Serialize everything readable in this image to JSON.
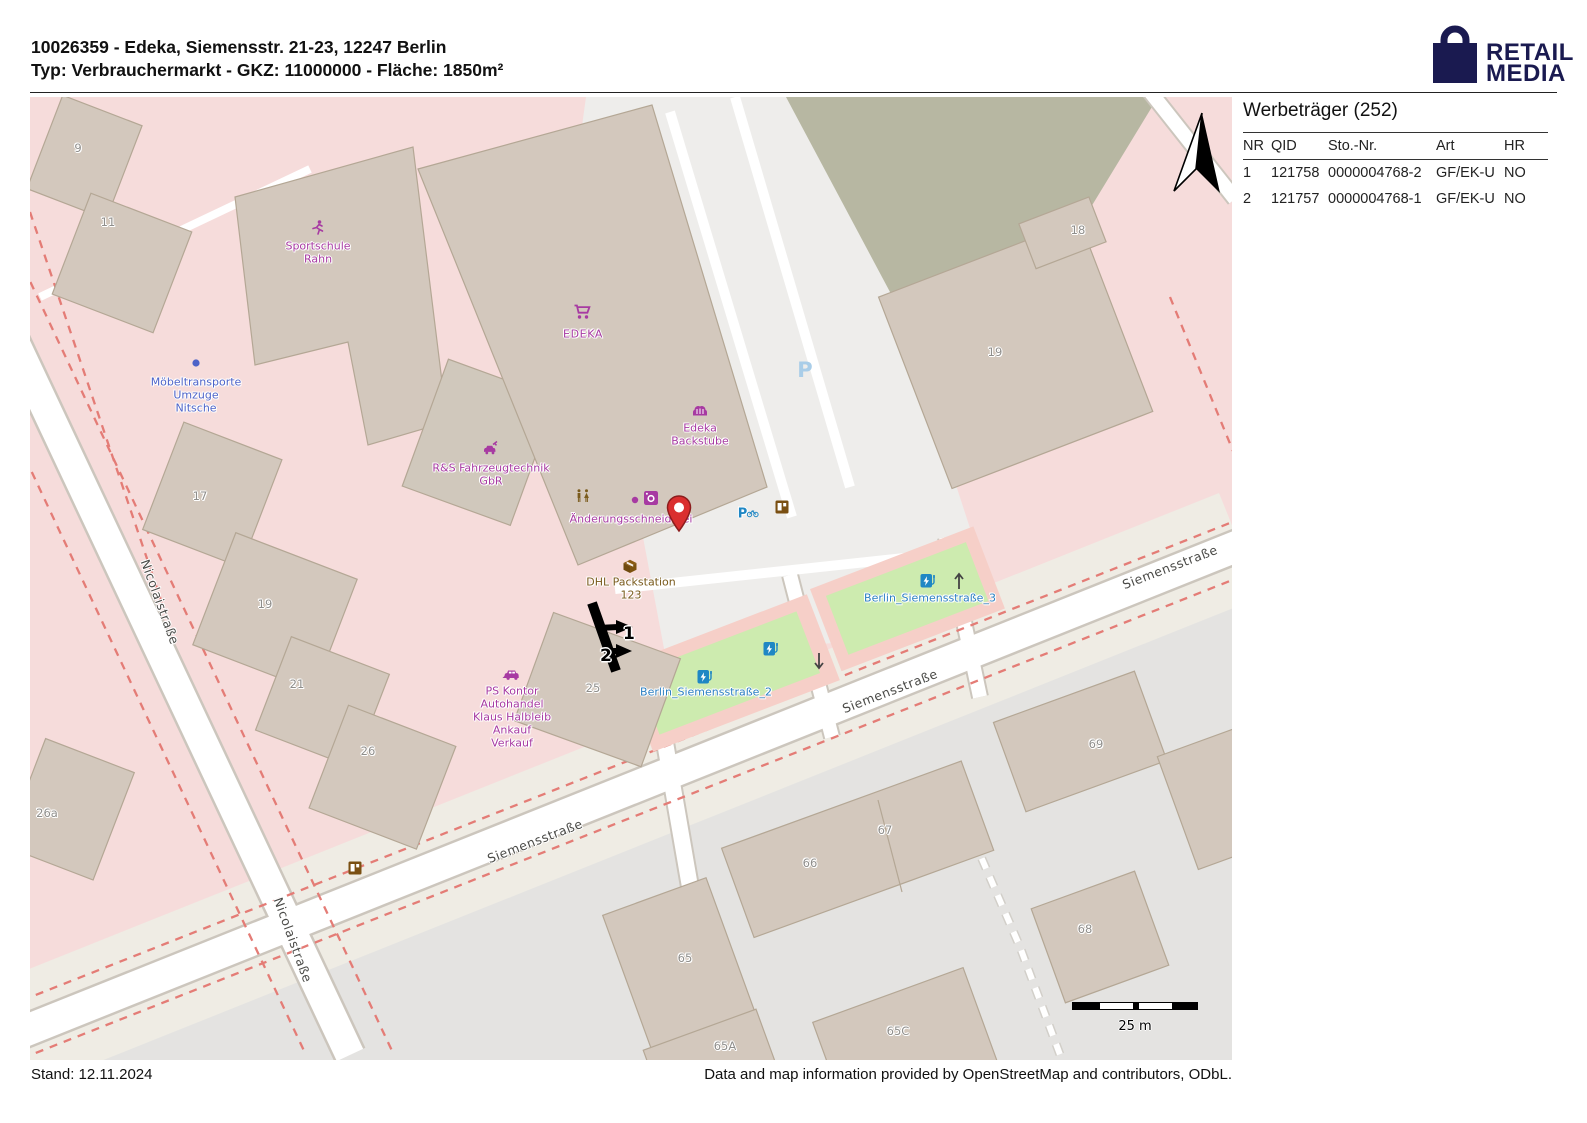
{
  "header": {
    "title_line1": "10026359 - Edeka, Siemensstr. 21-23, 12247 Berlin",
    "title_line2": "Typ: Verbrauchermarkt - GKZ: 11000000 - Fläche: 1850m²",
    "logo_line1": "RETAIL",
    "logo_line2": "MEDIA"
  },
  "panel": {
    "title": "Werbeträger (252)",
    "columns": [
      "NR",
      "QID",
      "Sto.-Nr.",
      "Art",
      "HR"
    ],
    "rows": [
      {
        "nr": "1",
        "qid": "121758",
        "sto_nr": "0000004768-2",
        "art": "GF/EK-U",
        "hr": "NO"
      },
      {
        "nr": "2",
        "qid": "121757",
        "sto_nr": "0000004768-1",
        "art": "GF/EK-U",
        "hr": "NO"
      }
    ]
  },
  "map": {
    "streets": {
      "nicolaistrasse": "Nicolaistraße",
      "siemensstrasse": "Siemensstraße"
    },
    "pois": {
      "sportschule_1": "Sportschule",
      "sportschule_2": "Rahn",
      "moebel_1": "Möbeltransporte",
      "moebel_2": "Umzuge",
      "moebel_3": "Nitsche",
      "edeka": "EDEKA",
      "backstube_1": "Edeka",
      "backstube_2": "Backstube",
      "fahrzeugtechnik_1": "R&S Fahrzeugtechnik",
      "fahrzeugtechnik_2": "GbR",
      "schneiderei": "Änderungsschneiderei",
      "dhl_1": "DHL Packstation",
      "dhl_2": "123",
      "pskontor_1": "PS Kontor",
      "pskontor_2": "Autohandel",
      "pskontor_3": "Klaus Halbleib",
      "pskontor_4": "Ankauf",
      "pskontor_5": "Verkauf",
      "charging_2": "Berlin_Siemensstraße_2",
      "charging_3": "Berlin_Siemensstraße_3",
      "parking_large": "P",
      "parking_small": "P"
    },
    "house_numbers": {
      "h9": "9",
      "h11": "11",
      "h17": "17",
      "h18": "18",
      "h19_left": "19",
      "h19_right": "19",
      "h21": "21",
      "h25": "25",
      "h26": "26",
      "h26a": "26a",
      "h65": "65",
      "h65a": "65A",
      "h65c": "65C",
      "h66": "66",
      "h67": "67",
      "h68": "68",
      "h69": "69"
    },
    "markers": {
      "marker_1": "1",
      "marker_2": "2"
    },
    "scale_label": "25 m"
  },
  "footer": {
    "stand": "Stand: 12.11.2024",
    "attribution": "Data and map information provided by OpenStreetMap and contributors, ODbL."
  },
  "colors": {
    "brand_navy": "#1a1a50",
    "poi_magenta": "#a73aa2",
    "poi_blue": "#4d63c8",
    "charging_blue": "#1f87c4",
    "amenity_brown": "#7a5b1d",
    "pin_red": "#da2f2f",
    "grass_green": "#cdebaf",
    "building_fill": "#d3c8bd",
    "boundary_dash_red": "#e47c76"
  }
}
